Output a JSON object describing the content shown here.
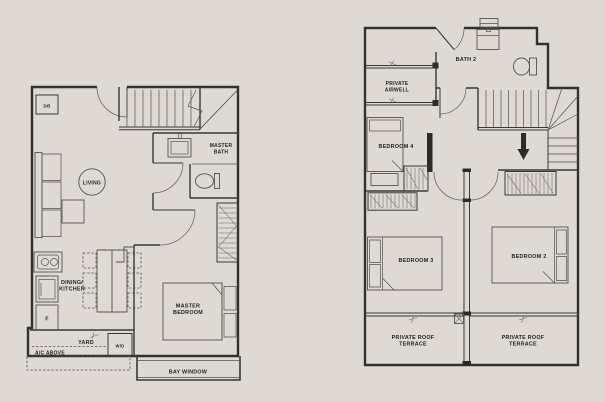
{
  "canvas": {
    "width": 605,
    "height": 402,
    "background_color": "#dedad2",
    "wall_color": "#34312c",
    "furniture_line_color": "#55524b",
    "text_color": "#26231e"
  },
  "plan_first_storey": {
    "labels": {
      "db": "DB",
      "living": "LIVING",
      "master_bath_1": "MASTER",
      "master_bath_2": "BATH",
      "dining_kitchen_1": "DINING/",
      "dining_kitchen_2": "KITCHEN",
      "fridge": "F",
      "yard": "YARD",
      "ac_above": "A/C ABOVE",
      "washer_dryer": "W/D",
      "master_bedroom_1": "MASTER",
      "master_bedroom_2": "BEDROOM",
      "bay_window": "BAY WINDOW"
    }
  },
  "plan_second_storey": {
    "labels": {
      "bath_2": "BATH 2",
      "private_airwell_1": "PRIVATE",
      "private_airwell_2": "AIRWELL",
      "bedroom_4": "BEDROOM 4",
      "bedroom_3": "BEDROOM 3",
      "bedroom_2": "BEDROOM 2",
      "terrace_left_1": "PRIVATE ROOF",
      "terrace_left_2": "TERRACE",
      "terrace_right_1": "PRIVATE ROOF",
      "terrace_right_2": "TERRACE"
    }
  }
}
